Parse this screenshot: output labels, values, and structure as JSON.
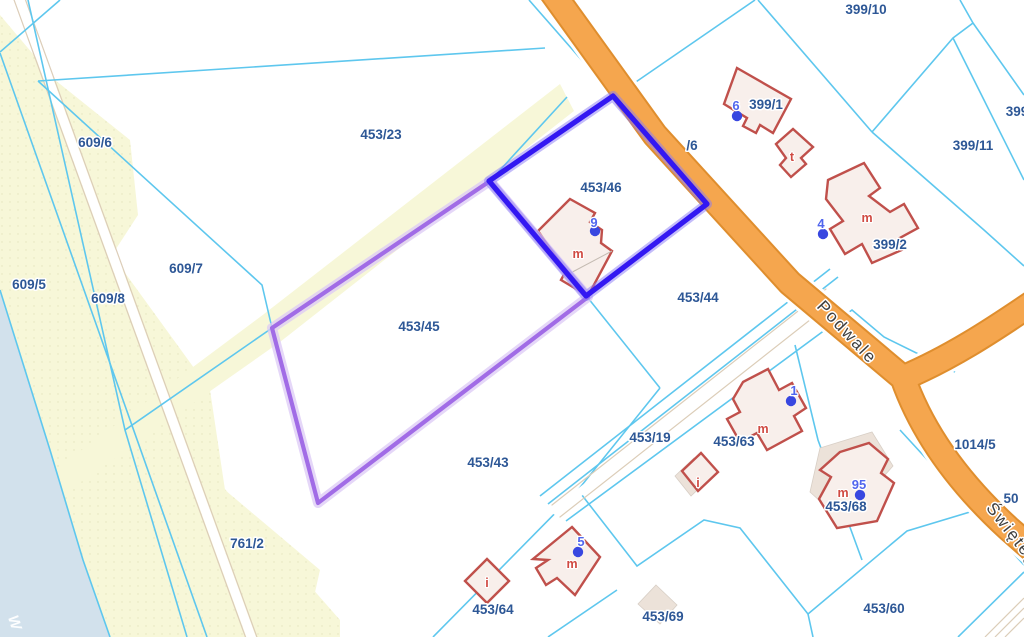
{
  "map": {
    "selected_parcel": "453/46",
    "highlighted_parcel": "453/45",
    "colors": {
      "parcel_line": "#5ec7ee",
      "selected_blue": "#3318f2",
      "highlight_purple": "#a16ce6",
      "road_fill": "#f5a64e",
      "road_casing": "#df8e2e",
      "building_stroke": "#c0504b",
      "building_fill": "#f8efeb",
      "building_shadow": "#ece2d9",
      "water": "#d2e1ec",
      "field": "#f7f7d8",
      "label_color": "#2d5796",
      "building_label_color": "#d04a42",
      "road_label_color": "#3f3f3f",
      "marker_dot": "#3847e0",
      "marker_text": "#5166ee",
      "track_edge": "#dccdb8"
    },
    "parcel_labels": [
      {
        "text": "609/6",
        "x": 95,
        "y": 147
      },
      {
        "text": "609/5",
        "x": 29,
        "y": 289
      },
      {
        "text": "609/7",
        "x": 186,
        "y": 273
      },
      {
        "text": "609/8",
        "x": 108,
        "y": 303
      },
      {
        "text": "453/23",
        "x": 381,
        "y": 139
      },
      {
        "text": "453/46",
        "x": 601,
        "y": 192
      },
      {
        "text": "453/44",
        "x": 698,
        "y": 302
      },
      {
        "text": "453/45",
        "x": 419,
        "y": 331
      },
      {
        "text": "453/43",
        "x": 488,
        "y": 467
      },
      {
        "text": "453/19",
        "x": 650,
        "y": 442
      },
      {
        "text": "453/63",
        "x": 734,
        "y": 446
      },
      {
        "text": "453/64",
        "x": 493,
        "y": 614
      },
      {
        "text": "453/69",
        "x": 663,
        "y": 621
      },
      {
        "text": "453/68",
        "x": 846,
        "y": 511
      },
      {
        "text": "453/60",
        "x": 884,
        "y": 613
      },
      {
        "text": "761/2",
        "x": 247,
        "y": 548
      },
      {
        "text": "1014/5",
        "x": 975,
        "y": 449
      },
      {
        "text": "399/10",
        "x": 866,
        "y": 14
      },
      {
        "text": "399/1",
        "x": 766,
        "y": 109
      },
      {
        "text": "399/2",
        "x": 890,
        "y": 249
      },
      {
        "text": "399/11",
        "x": 973,
        "y": 150
      },
      {
        "text": "399",
        "x": 1017,
        "y": 116
      },
      {
        "text": "/6",
        "x": 692,
        "y": 150
      },
      {
        "text": "50",
        "x": 1011,
        "y": 503
      }
    ],
    "building_labels": [
      {
        "text": "m",
        "x": 578,
        "y": 258
      },
      {
        "text": "t",
        "x": 792,
        "y": 161
      },
      {
        "text": "m",
        "x": 867,
        "y": 222
      },
      {
        "text": "m",
        "x": 763,
        "y": 433
      },
      {
        "text": "i",
        "x": 698,
        "y": 487
      },
      {
        "text": "m",
        "x": 572,
        "y": 568
      },
      {
        "text": "i",
        "x": 487,
        "y": 587
      },
      {
        "text": "m",
        "x": 843,
        "y": 497
      }
    ],
    "address_markers": [
      {
        "number": "9",
        "tx": 594,
        "ty": 227,
        "dx": 595,
        "dy": 231
      },
      {
        "number": "6",
        "tx": 736,
        "ty": 110,
        "dx": 737,
        "dy": 116
      },
      {
        "number": "4",
        "tx": 821,
        "ty": 228,
        "dx": 823,
        "dy": 234
      },
      {
        "number": "1",
        "tx": 794,
        "ty": 395,
        "dx": 791,
        "dy": 401
      },
      {
        "number": "95",
        "tx": 859,
        "ty": 489,
        "dx": 860,
        "dy": 495
      },
      {
        "number": "5",
        "tx": 581,
        "ty": 546,
        "dx": 578,
        "dy": 552
      }
    ],
    "road_labels": [
      {
        "text": "Podwale"
      },
      {
        "text": "Świętego"
      }
    ],
    "water_label": "W"
  }
}
